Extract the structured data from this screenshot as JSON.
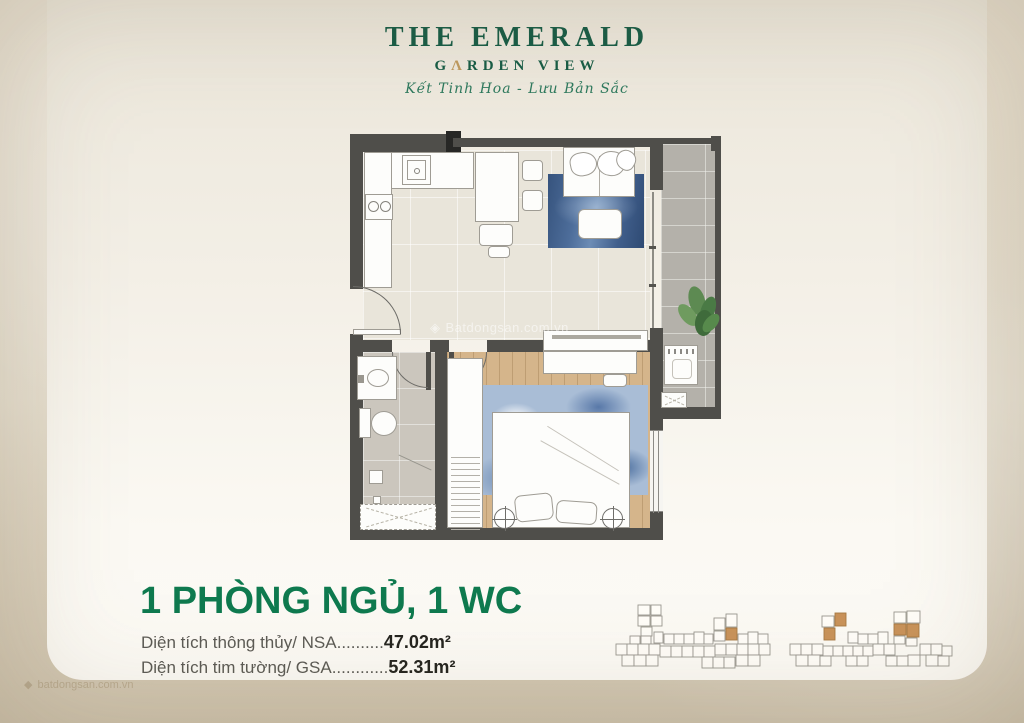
{
  "brand": {
    "title": "THE EMERALD",
    "subtitle_prefix": "G",
    "subtitle_mark": "Λ",
    "subtitle_suffix": "RDEN VIEW",
    "tagline": "Kết Tinh Hoa - Lưu Bản Sắc"
  },
  "unit": {
    "headline": "1 PHÒNG NGỦ, 1 WC",
    "areas": [
      {
        "label": "Diện tích thông thủy/ NSA",
        "dots": "..........",
        "value": "47.02m²"
      },
      {
        "label": "Diện tích tim tường/ GSA",
        "dots": "............",
        "value": "52.31m²"
      }
    ]
  },
  "watermark": {
    "center": "Batdongsan.com.vn",
    "corner": "batdongsan.com.vn"
  },
  "colors": {
    "brand_green": "#175c46",
    "accent_gold": "#bf9a5f",
    "headline_green": "#0f7a4f",
    "wall": "#4f4e4a",
    "unit_highlight": "#c9935a"
  }
}
